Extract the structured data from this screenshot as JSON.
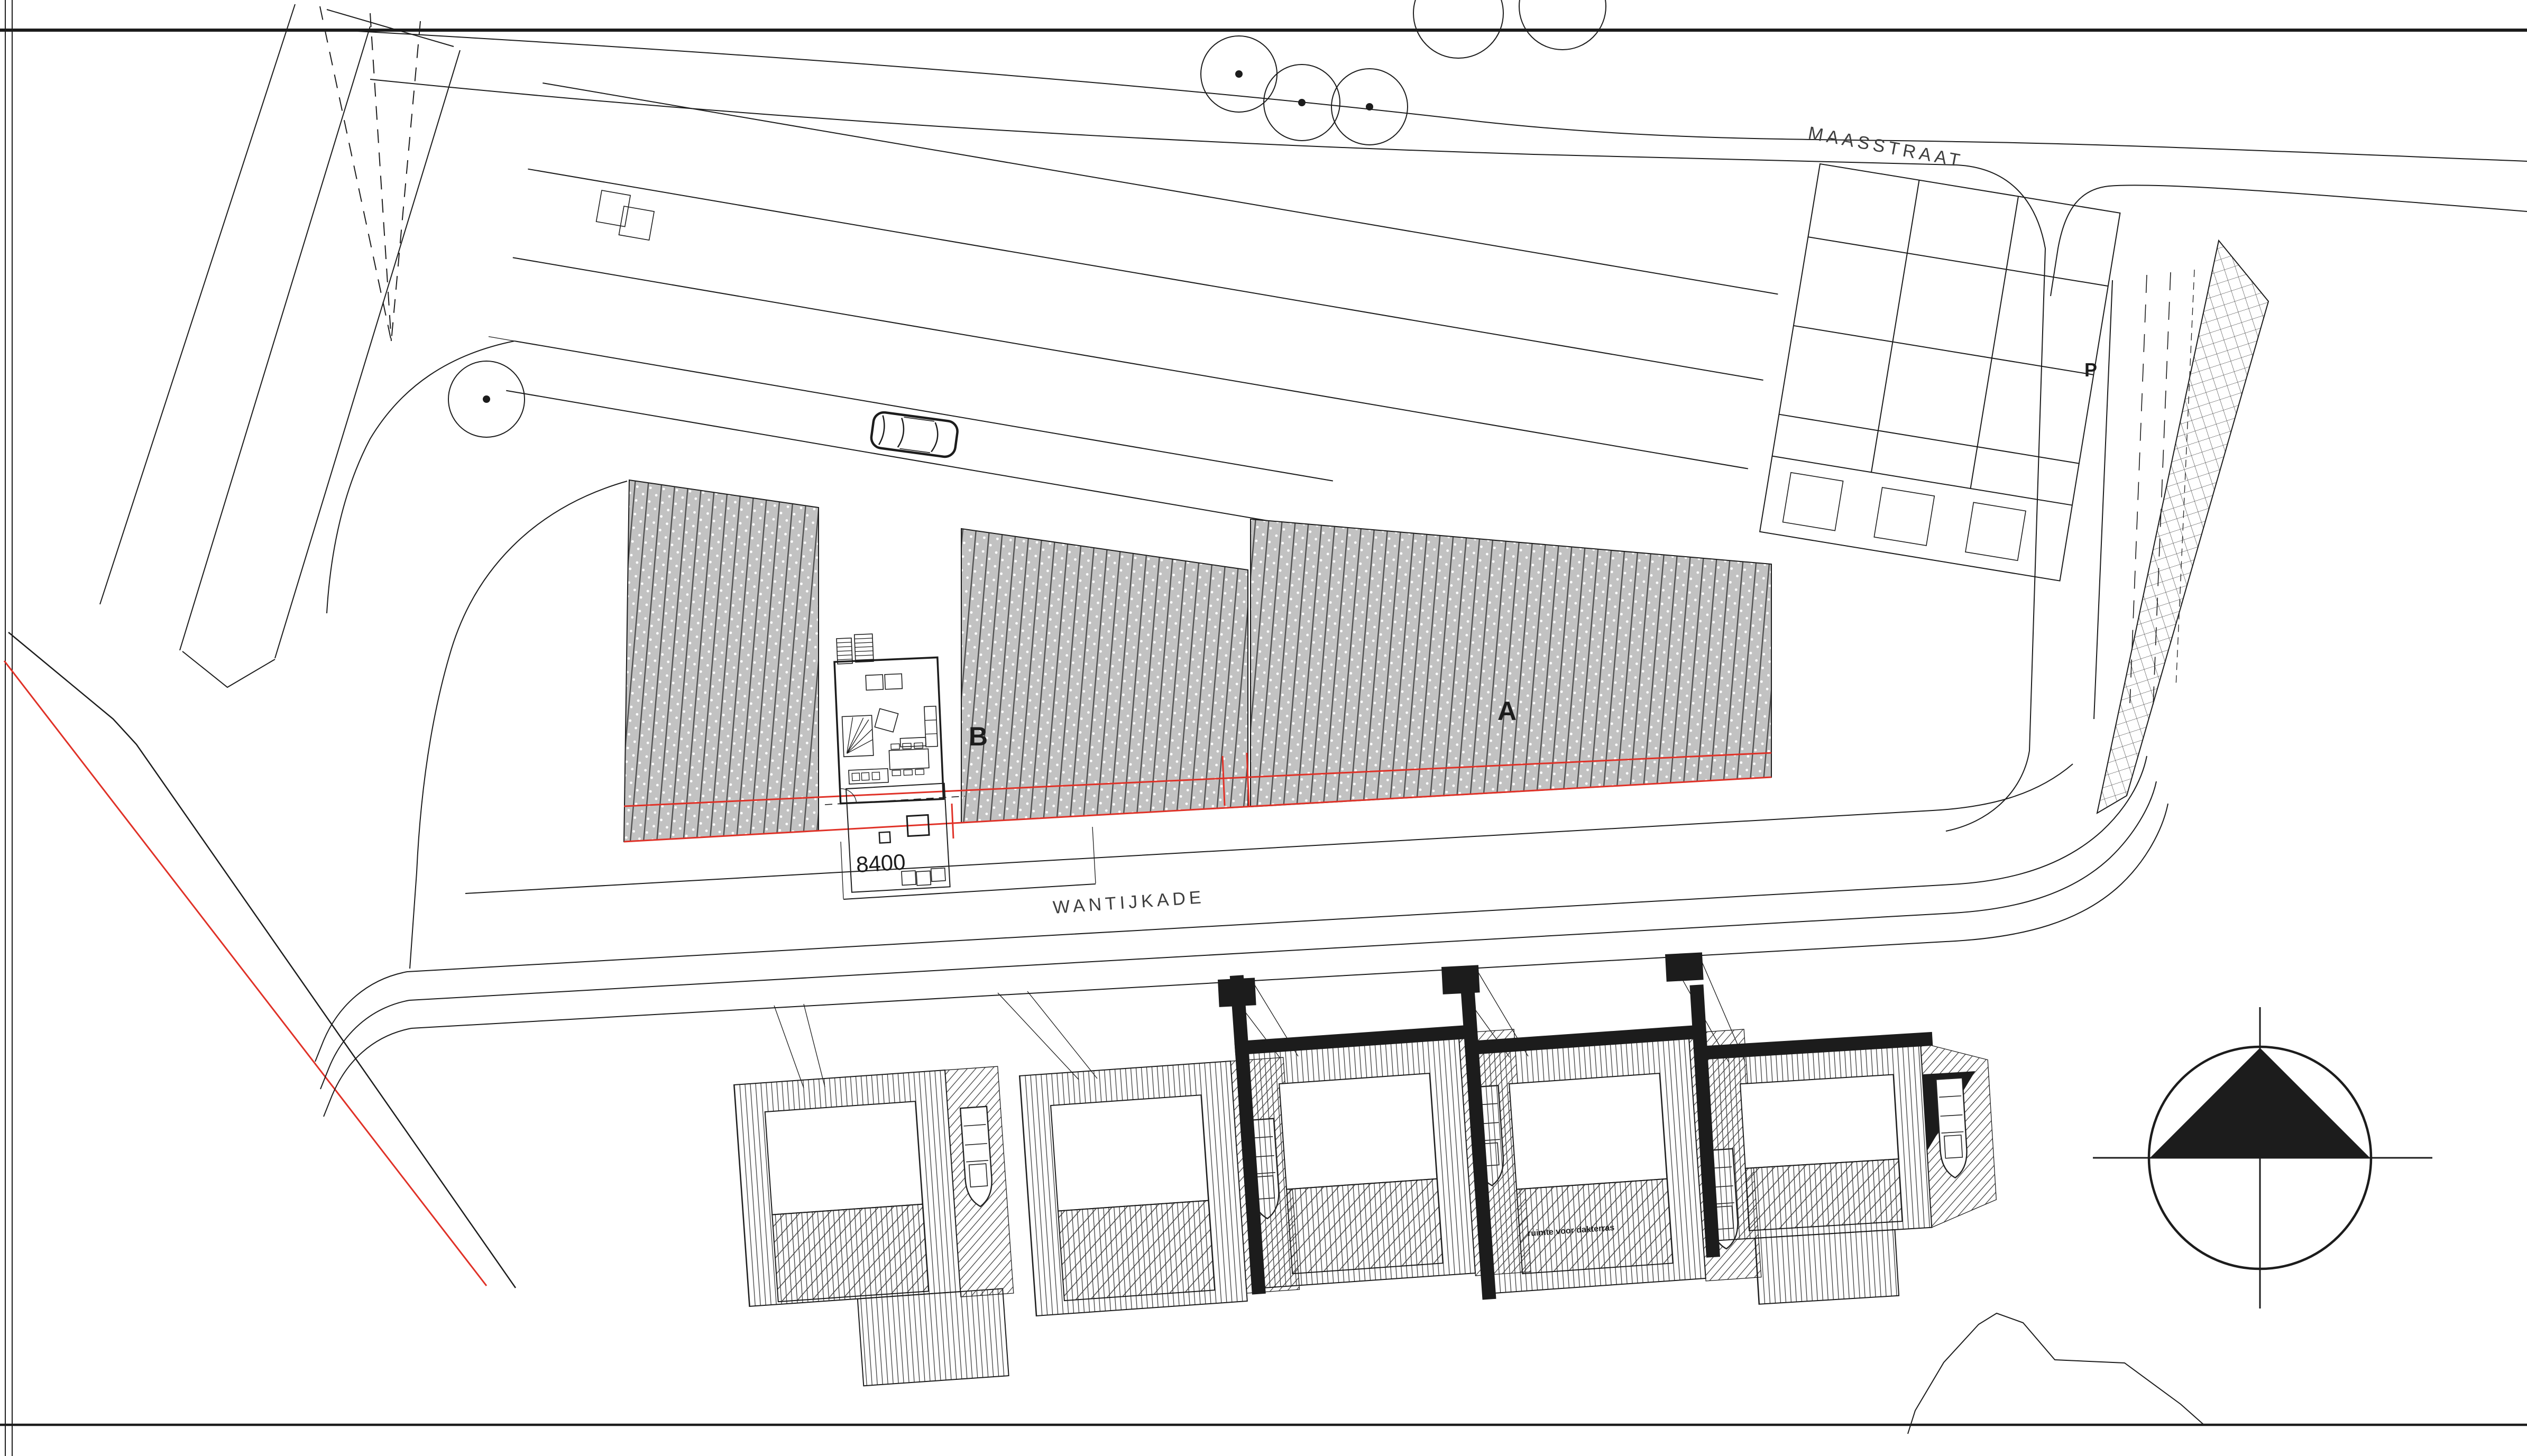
{
  "labels": {
    "maasstraat": "MAASSTRAAT",
    "wantijkade": "WANTIJKADE",
    "parcel_a": "A",
    "parcel_b": "B",
    "parking": "P",
    "dimension": "8400",
    "roof_terrace_note": "ruimte voor dakterras"
  },
  "colors": {
    "line": "#1c1c1c",
    "boundary_red": "#e03127",
    "parcel_fill": "#c2c2c2",
    "parcel_hatch_line": "#4d4d4d",
    "paper": "#ffffff"
  }
}
